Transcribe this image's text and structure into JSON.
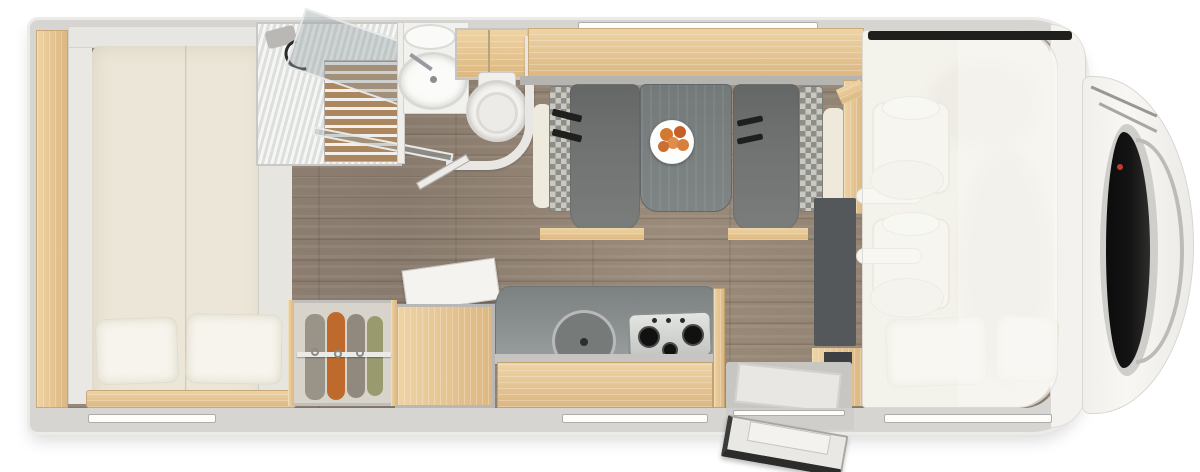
{
  "meta": {
    "kind": "motorhome-floorplan-top-view"
  },
  "labels": {
    "scene": "Motorhome interior floor plan, top-down view",
    "vehicle": "motorhome body shell",
    "bed": "rear double bed with pillows",
    "shower": "shower cubicle with duckboard and glass door",
    "washbasin": "bathroom washbasin unit",
    "toilet": "toilet with curved partition",
    "wardrobe": "open wardrobe with hanging clothes",
    "fridge": "refrigerator cabinet with open flap",
    "kitchen": "kitchen block with round sink and 3-burner gas hob",
    "dinette": "dinette with two benches and table",
    "plate": "plate of fruit on table",
    "media": "dark media cabinet panel",
    "entrance": "entrance with step well and open door",
    "cab": "cab seats under semi-transparent drop-down bed",
    "front": "vehicle front with windshield and wipers"
  },
  "palette": {
    "bg": "#ffffff",
    "wall": "#d6d5d2",
    "wallEdge": "#ecebe8",
    "bodyWhite": "#f3f2ee",
    "floorA": "#95867a",
    "floorB": "#887a6c",
    "woodA": "#eed3a4",
    "woodB": "#dcb781",
    "duck": "#ab865e",
    "mattress": "#ebe6d7",
    "pillow": "#f6f4ec",
    "cream": "#efeade",
    "bench": "#6f7270",
    "tableTop": "#7f8585",
    "checkA": "#c9c9c3",
    "checkB": "#8e8e87",
    "counter": "#8b9091",
    "slate": "#54585a",
    "clothesOrange": "#bf6a2d",
    "clothesGray": "#9a9388",
    "clothesGreen": "#999a6e",
    "fruit": "#d4772f",
    "glass": "rgba(150,160,164,0.40)",
    "dark": "#1f1f1d",
    "windshield": "#141414",
    "hood": "#f8f7f4",
    "chrome": "#bcbbb8",
    "red": "#c23b2e",
    "slot": "#fdfdfc"
  }
}
